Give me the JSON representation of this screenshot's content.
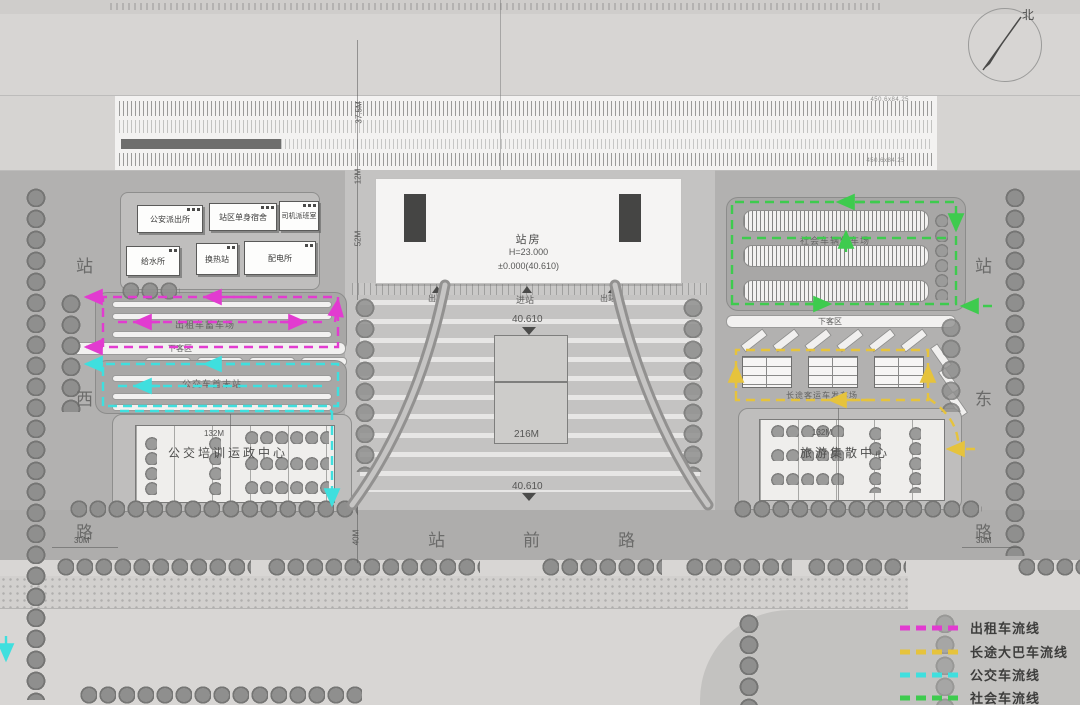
{
  "compass": {
    "north": "北"
  },
  "colors": {
    "taxi": "#e23bd0",
    "coach": "#e6c33c",
    "bus": "#3fdfde",
    "social": "#3ecb4e"
  },
  "legend": {
    "items": [
      {
        "label": "出租车流线",
        "color": "#e23bd0"
      },
      {
        "label": "长途大巴车流线",
        "color": "#e6c33c"
      },
      {
        "label": "公交车流线",
        "color": "#3fdfde"
      },
      {
        "label": "社会车流线",
        "color": "#3ecb4e"
      }
    ]
  },
  "rail": {
    "platform_label_top": "450.6x84.25",
    "platform_label_bottom": "450.6x84.25"
  },
  "station": {
    "name": "站房",
    "height": "H=23.000",
    "level": "±0.000(40.610)",
    "enter": "进站",
    "exit_left": "出站",
    "exit_right": "出站"
  },
  "buildings": [
    {
      "label": "公安派出所"
    },
    {
      "label": "站区单身宿舍"
    },
    {
      "label": "司机派班室"
    },
    {
      "label": "给水所"
    },
    {
      "label": "换热站"
    },
    {
      "label": "配电所"
    }
  ],
  "zones": {
    "taxi_lot": "出租车蓄车场",
    "dropoff_left": "下客区",
    "bus_terminal": "公交车首末站",
    "training_center": "公交培训运政中心",
    "social_parking": "社会车辆停车场",
    "dropoff_right": "下客区",
    "coach_yard": "长途客运车发车场",
    "tourist_center": "旅游集散中心"
  },
  "roads": {
    "west": [
      "站",
      "西",
      "路"
    ],
    "east": [
      "站",
      "东",
      "路"
    ],
    "front": [
      "站",
      "前",
      "路"
    ]
  },
  "dimensions": {
    "rail_width": "37.5M",
    "gap": "12M",
    "station_depth": "52M",
    "front_road": "40M",
    "west_road": "30M",
    "east_road": "30M",
    "left_block": "132M",
    "right_block": "132M",
    "plaza_width": "216M",
    "elev_top": "40.610",
    "elev_bottom": "40.610"
  }
}
